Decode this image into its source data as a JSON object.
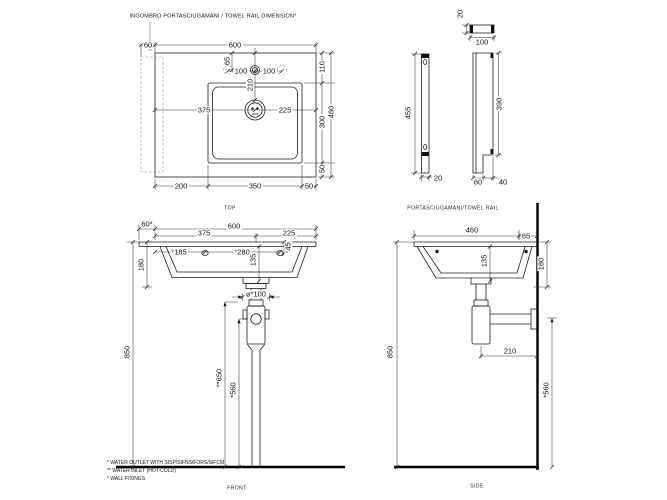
{
  "title": "INGOMBRO PORTASCIUGAMANI / TOWEL RAIL DIMENSION*",
  "top_view": {
    "caption": "TOP",
    "dims": {
      "rail_overhang": "60",
      "width": "600",
      "back_to_bowl": "110",
      "bowl_depth": "300",
      "overall_depth": "460",
      "front_edge": "50",
      "tap_from_back": "65",
      "tap_left": "100",
      "tap_right": "100",
      "tap_to_drain": "210",
      "drain_from_left": "375",
      "drain_to_right": "225",
      "left_to_bowl": "200",
      "bowl_width": "350",
      "bowl_to_right": "50"
    }
  },
  "towel_rail_view": {
    "caption": "PORTASCIUGAMANI/TOWEL RAIL",
    "dims": {
      "length": "455",
      "bar_width": "20",
      "cap_height": "20",
      "profile_width": "100",
      "drop": "390",
      "foot_width": "60",
      "notch": "40"
    }
  },
  "front_view": {
    "caption": "FRONT",
    "dims": {
      "rail_overhang": "60*",
      "width": "600",
      "drain_from_left": "375",
      "drain_to_right": "225",
      "fixing_from_left": "°185",
      "fixing_spacing": "°280",
      "basin_depth": "135",
      "fixing_drop": "°45",
      "front_height": "180",
      "rim_height": "850",
      "outlet_dia": "⌀*100",
      "inlet_height": "**650",
      "outlet_height": "*560"
    }
  },
  "side_view": {
    "caption": "SIDE",
    "dims": {
      "depth": "460",
      "back_offset": "65",
      "basin_depth": "135",
      "front_height": "180",
      "rim_height": "850",
      "trap_to_wall": "210",
      "outlet_height": "*560"
    }
  },
  "footnotes": {
    "water_outlet": "* WATER OUTLET WITH SISP/SIFNS/FORS/SIFCM",
    "water_inlet": "** WATER INLET  (HOT-COLD)",
    "wall_fixings": "° WALL FIXINGS"
  },
  "colors": {
    "line": "#1c1c1c",
    "dim_line": "#333333",
    "phantom": "#888888",
    "background": "#ffffff"
  }
}
